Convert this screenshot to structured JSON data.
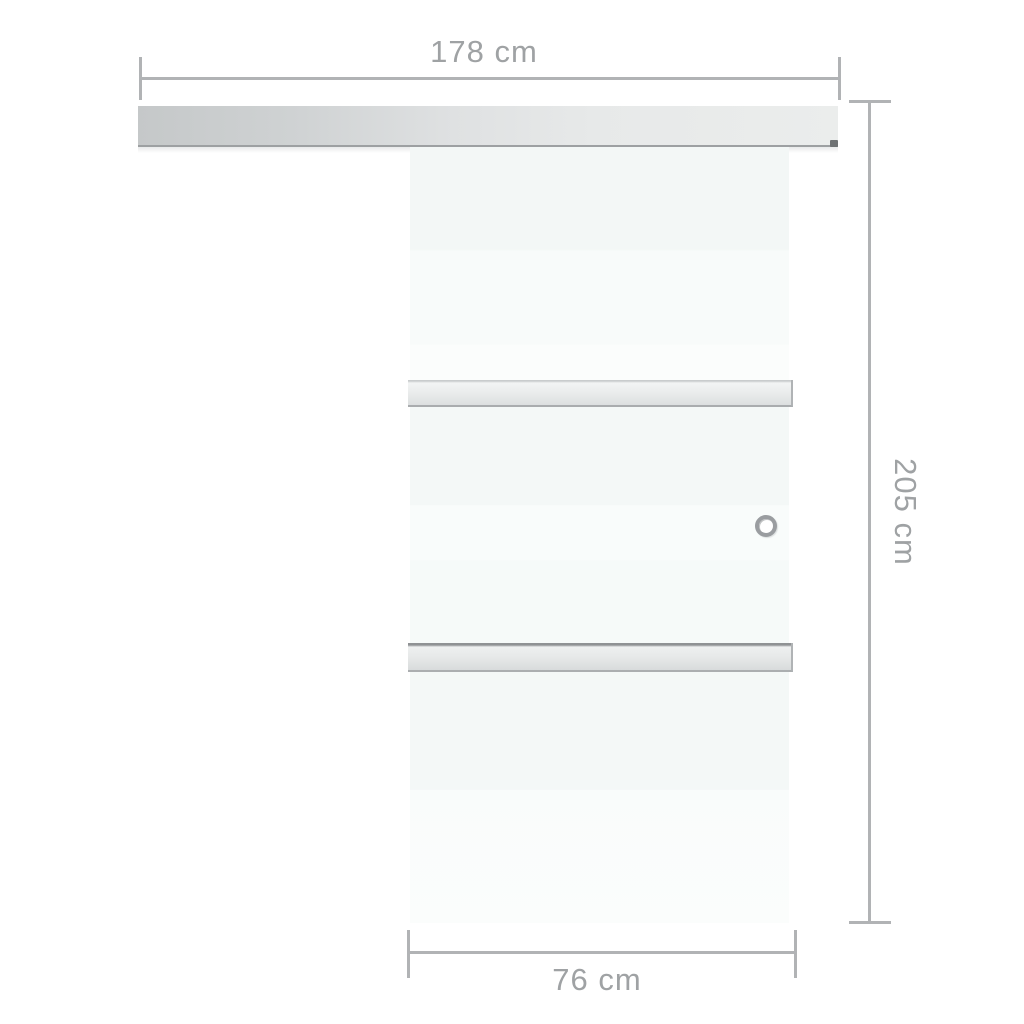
{
  "diagram": {
    "type": "product-dimension-diagram",
    "subject": "sliding glass door with top rail, two stop bars and round handle",
    "labels": {
      "total_width": "178 cm",
      "total_height": "205 cm",
      "door_width": "76 cm"
    },
    "colors": {
      "background": "#ffffff",
      "dimension_line": "#b1b3b5",
      "label_text": "#9fa2a4",
      "rail_gradient_left": "#c5c8c9",
      "rail_gradient_right": "#ebedec",
      "rail_bottom_edge": "#9da0a2",
      "glass_base": "#f4f8f7",
      "stop_bar_highlight": "#f2f4f4",
      "stop_bar_shade": "#d8dbdc",
      "stop_bar_edge": "#a9acae",
      "handle_ring": "#9a9da0"
    }
  }
}
